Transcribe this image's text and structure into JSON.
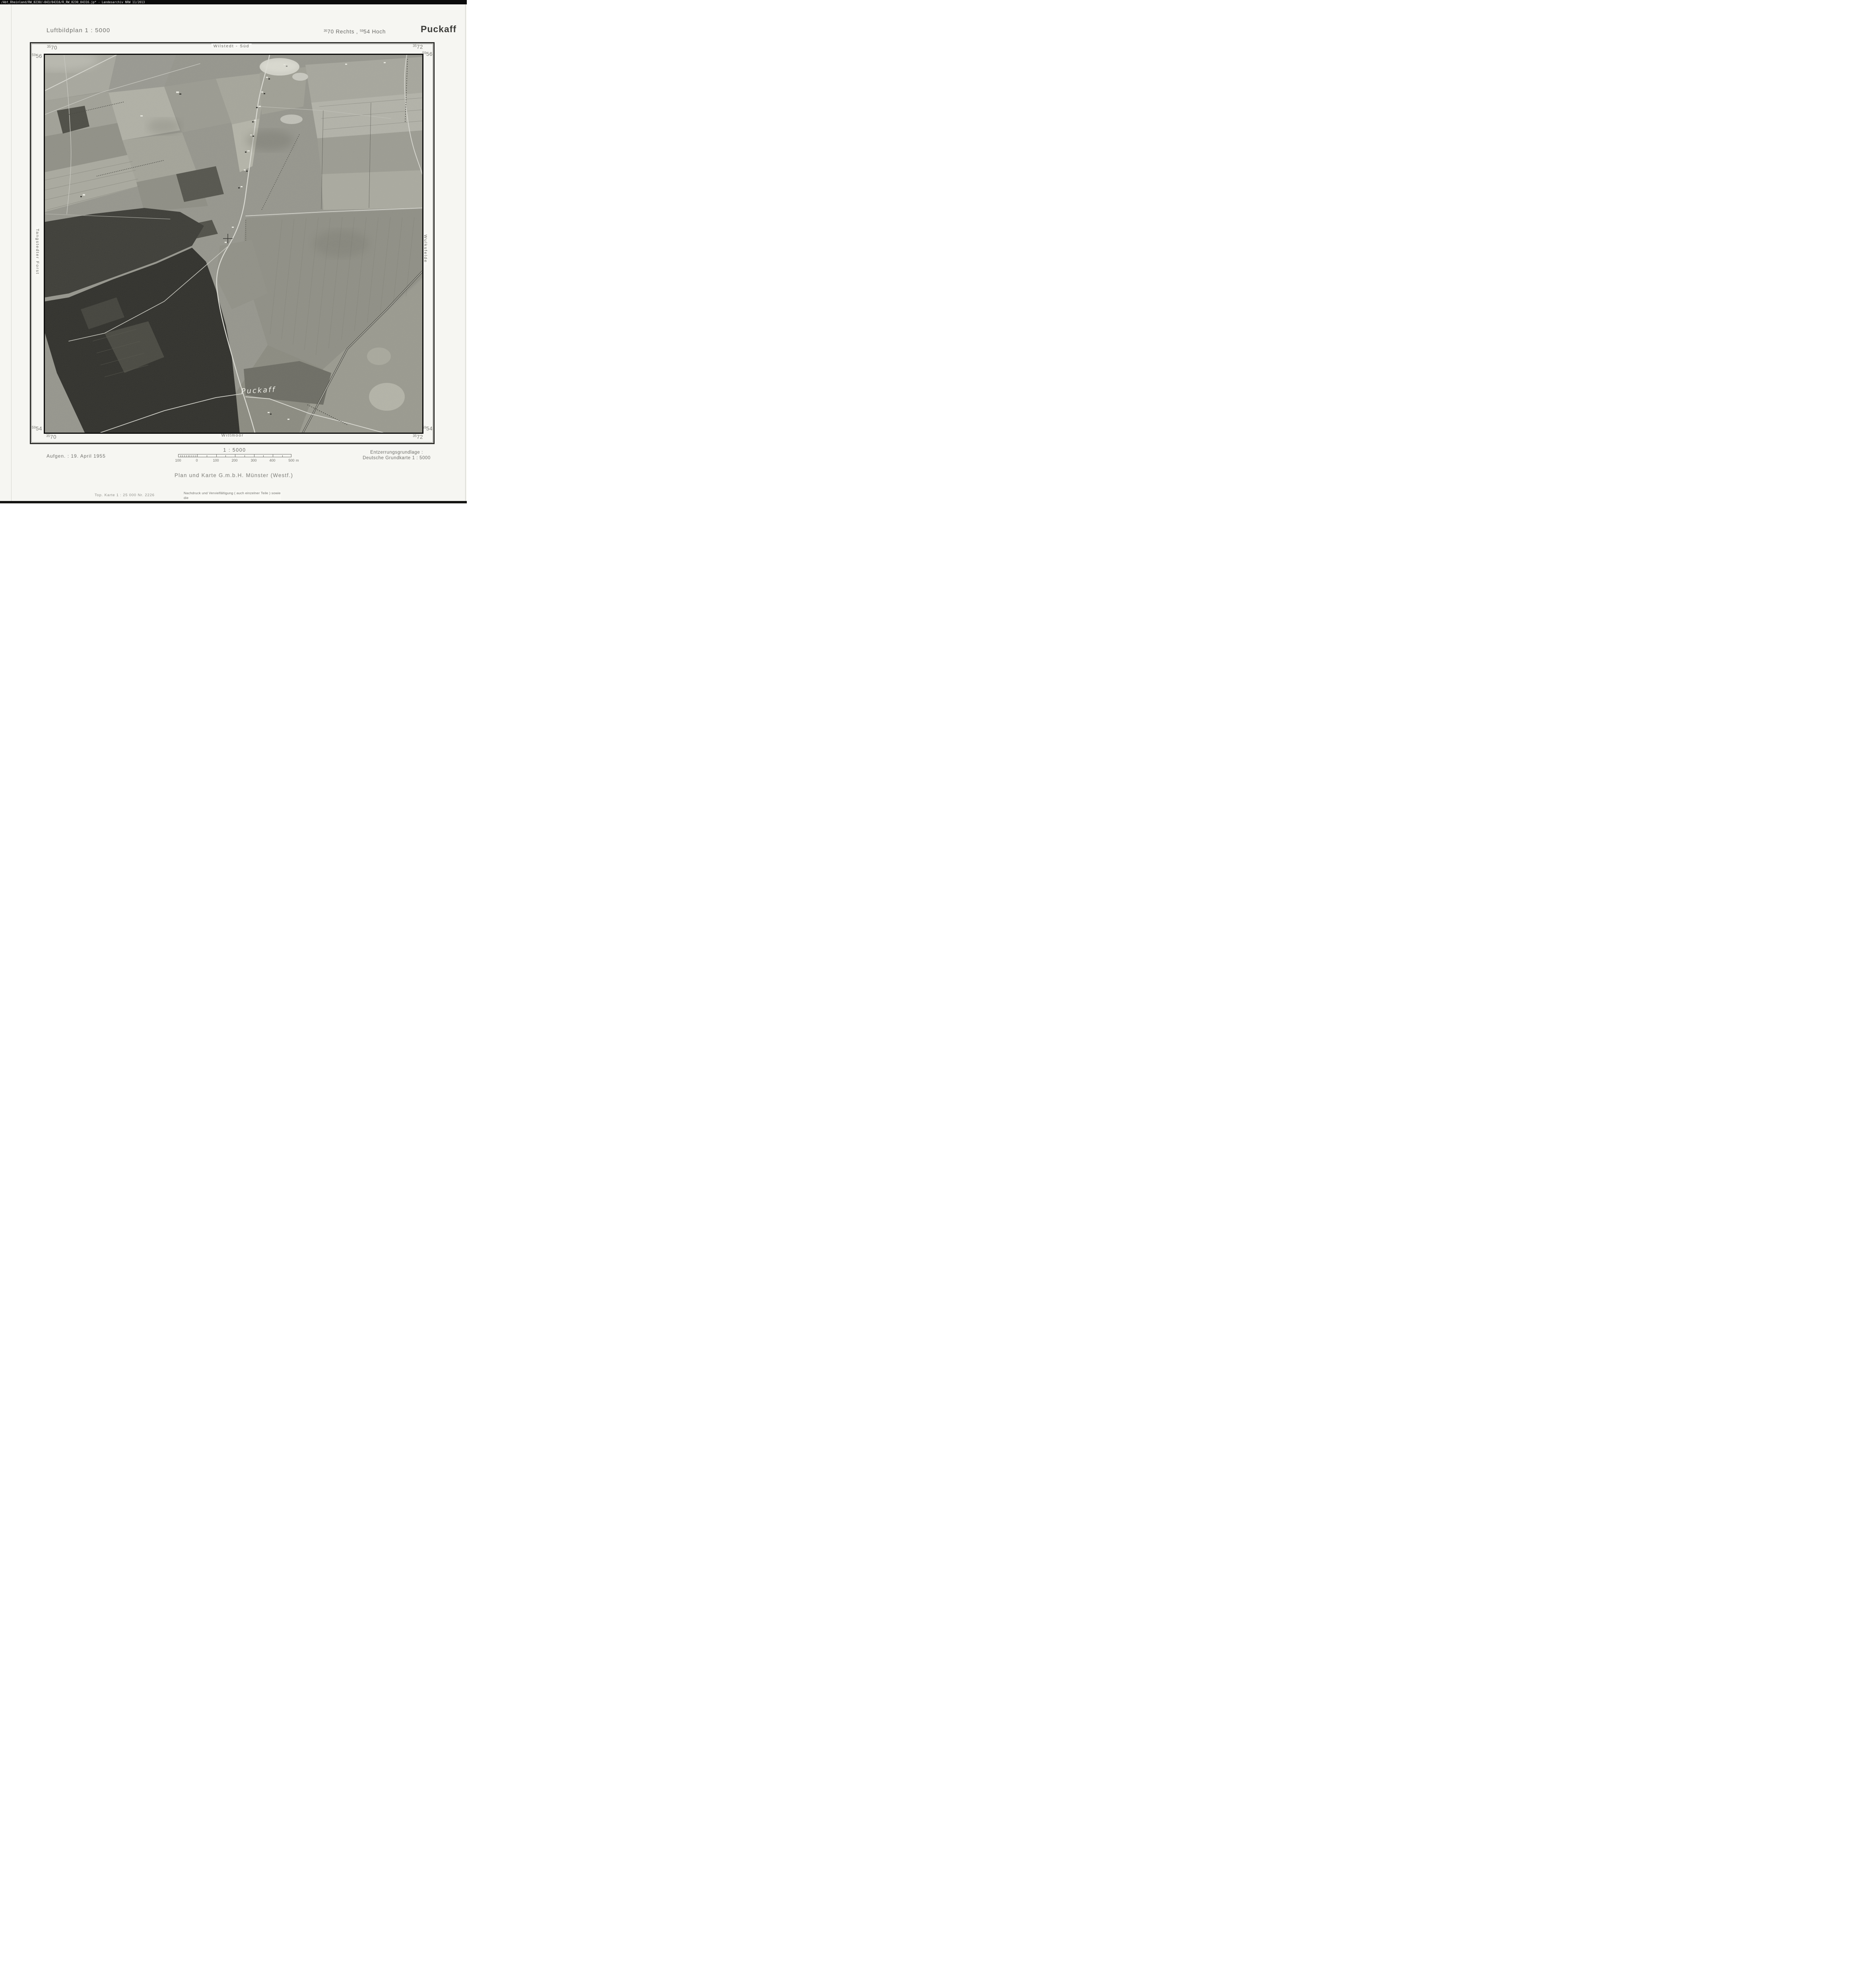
{
  "scan": {
    "archive_header": "/Abt_Rheinland/RW_0230/~043/04316/R_RW_0230_04316.jp* -  Landesarchiv NRW  11/2013"
  },
  "header": {
    "series_title": "Luftbildplan 1 : 5000",
    "grid_rechts_sup": "35",
    "grid_rechts": "70 Rechts ,",
    "grid_hoch_sup": "59",
    "grid_hoch": "54 Hoch",
    "sheet_name": "Puckaff"
  },
  "map": {
    "corners": {
      "top_left": {
        "x_sup": "35",
        "x": "70",
        "y_sup": "59",
        "y": "56"
      },
      "top_right": {
        "x_sup": "35",
        "x": "72",
        "y_sup": "59",
        "y": "56"
      },
      "bottom_left": {
        "x_sup": "59",
        "y": "54",
        "x_sup2": "35",
        "x": "70"
      },
      "bottom_right": {
        "x_sup": "59",
        "y": "54",
        "x_sup2": "35",
        "x": "72"
      }
    },
    "neighbors": {
      "top": "Wilstedt - Süd",
      "bottom": "Wittmoor",
      "left": "Tangstedter Forst",
      "right": "Wulksfelde"
    },
    "photo_place_label": "Puckaff"
  },
  "footer": {
    "acquisition": "Aufgen. : 19. April 1955",
    "scale_text": "1 : 5000",
    "scale_bar": {
      "labels": [
        "100",
        "0",
        "100",
        "200",
        "300",
        "400",
        "500"
      ],
      "unit": "m"
    },
    "rectification1": "Entzerrungsgrundlage :",
    "rectification2": "Deutsche Grundkarte 1 : 5000",
    "publisher": "Plan und Karte G.m.b.H. Münster (Westf.)",
    "topo_note": "Top. Karte 1 : 25 000  Nr. 2226",
    "copyright1": "Nachdruck und Vervielfältigung ( auch einzelner Teile ) sowie die",
    "copyright2": "Anfertigung von Vergrößerungen oder Verkleinerungen sind verboten."
  }
}
